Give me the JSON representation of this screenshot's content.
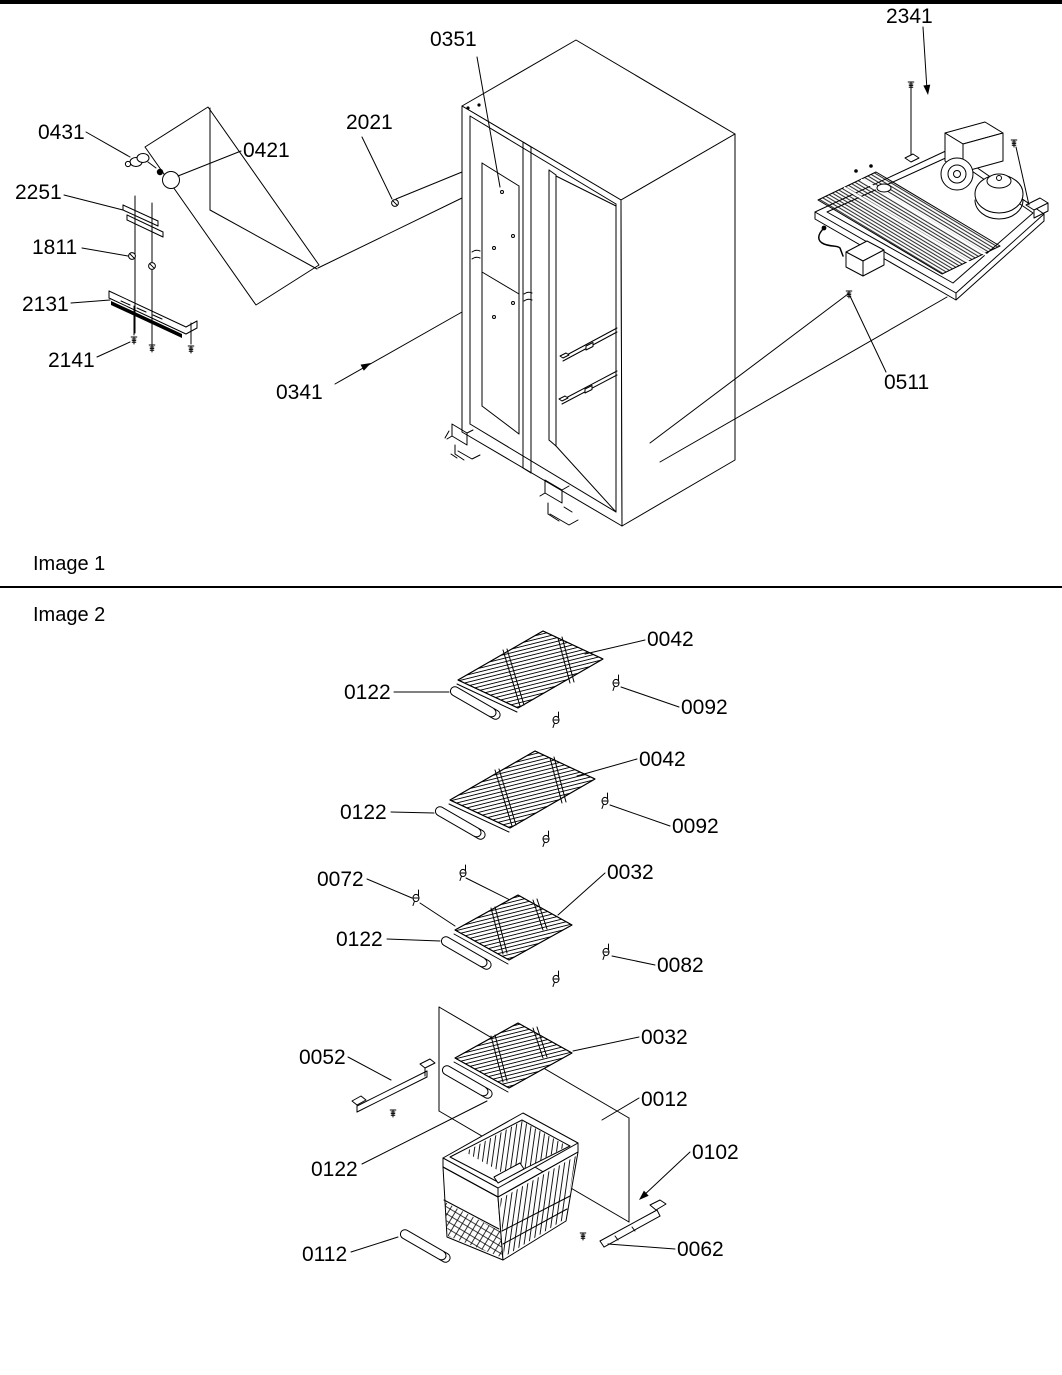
{
  "document": {
    "kind": "exploded-parts-diagram",
    "colors": {
      "ink": "#000000",
      "paper": "#ffffff"
    }
  },
  "image1": {
    "title": "Image 1",
    "callouts": {
      "light_socket": "0431",
      "light_bulb": "0421",
      "light_shield_bracket": "2251",
      "shield_screw_upper": "1811",
      "light_shield": "2131",
      "shield_screw_lower": "2141",
      "cabinet_screw_front": "2021",
      "cabinet_back_panel": "0351",
      "cabinet_screw_lower": "0341",
      "machine_screw": "2341",
      "machine_mount_screw": "0511"
    }
  },
  "image2": {
    "title": "Image 2",
    "callouts": {
      "shelf1": "0042",
      "shelf1_trim": "0122",
      "shelf1_clips": "0092",
      "shelf2": "0042",
      "shelf2_trim": "0122",
      "shelf2_clips": "0092",
      "shelf3_rear_clips": "0072",
      "shelf3": "0032",
      "shelf3_trim": "0122",
      "shelf3_front_clips": "0082",
      "shelf4_rail": "0052",
      "shelf4": "0032",
      "freezer_divider": "0012",
      "shelf4_trim": "0122",
      "basket_rail_front": "0102",
      "basket_trim": "0112",
      "basket_rail_rear": "0062"
    }
  }
}
